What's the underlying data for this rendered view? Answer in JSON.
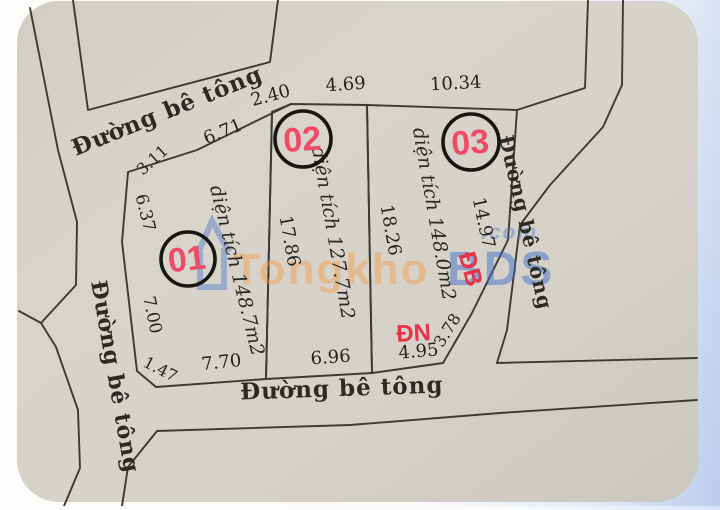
{
  "diagram": {
    "colors": {
      "paper": "#d6d2ca",
      "paper_edge": "#c8c4bb",
      "line": "#3c3a33",
      "text": "#25241e",
      "plot_number_red": "#ef4b66",
      "direction_red": "#e73349",
      "watermark_orange": "#f59a40",
      "watermark_blue": "#3e6dc9",
      "background_right": "#b9cceb"
    },
    "lines": [
      {
        "name": "top-parcel-boundary",
        "closed": false,
        "pts": [
          [
            73,
            0
          ],
          [
            88,
            110
          ],
          [
            270,
            62
          ],
          [
            278,
            0
          ]
        ]
      },
      {
        "name": "left-outer-boundary-upper",
        "closed": false,
        "pts": [
          [
            30,
            8
          ],
          [
            58,
            150
          ],
          [
            77,
            222
          ],
          [
            76,
            285
          ],
          [
            41,
            323
          ]
        ]
      },
      {
        "name": "left-boundary-fork",
        "closed": false,
        "pts": [
          [
            41,
            323
          ],
          [
            19,
            311
          ]
        ]
      },
      {
        "name": "left-outer-boundary-lower",
        "closed": false,
        "pts": [
          [
            41,
            323
          ],
          [
            56,
            347
          ],
          [
            78,
            410
          ],
          [
            80,
            468
          ],
          [
            64,
            506
          ]
        ]
      },
      {
        "name": "plot-01-boundary",
        "closed": true,
        "pts": [
          [
            291,
            104
          ],
          [
            197,
            150
          ],
          [
            128,
            172
          ],
          [
            122,
            242
          ],
          [
            137,
            371
          ],
          [
            156,
            387
          ],
          [
            266,
            379
          ],
          [
            272,
            112
          ]
        ]
      },
      {
        "name": "plot-02-boundary",
        "closed": true,
        "pts": [
          [
            272,
            112
          ],
          [
            291,
            104
          ],
          [
            367,
            105
          ],
          [
            372,
            373
          ],
          [
            266,
            379
          ]
        ]
      },
      {
        "name": "plot-03-boundary",
        "closed": true,
        "pts": [
          [
            367,
            105
          ],
          [
            517,
            110
          ],
          [
            508,
            240
          ],
          [
            472,
            313
          ],
          [
            443,
            363
          ],
          [
            372,
            373
          ]
        ]
      },
      {
        "name": "right-road-inner-boundary",
        "closed": false,
        "pts": [
          [
            588,
            0
          ],
          [
            585,
            88
          ],
          [
            517,
            110
          ]
        ]
      },
      {
        "name": "right-road-outer-boundary",
        "closed": false,
        "pts": [
          [
            623,
            0
          ],
          [
            622,
            85
          ],
          [
            603,
            127
          ],
          [
            550,
            185
          ],
          [
            520,
            225
          ],
          [
            507,
            330
          ],
          [
            497,
            363
          ]
        ]
      },
      {
        "name": "right-parcel-top-boundary",
        "closed": false,
        "pts": [
          [
            497,
            363
          ],
          [
            697,
            358
          ]
        ]
      },
      {
        "name": "bottom-parcel-boundary",
        "closed": false,
        "pts": [
          [
            157,
            431
          ],
          [
            350,
            425
          ],
          [
            500,
            413
          ],
          [
            697,
            400
          ]
        ]
      },
      {
        "name": "bottom-left-boundary",
        "closed": false,
        "pts": [
          [
            157,
            431
          ],
          [
            128,
            467
          ],
          [
            122,
            506
          ]
        ]
      }
    ],
    "road_labels": [
      {
        "name": "road-label-top",
        "text": "Đường bê tông",
        "x": 170,
        "y": 118,
        "rot": -22,
        "size": 23
      },
      {
        "name": "road-label-left",
        "text": "Đường bê tông",
        "x": 108,
        "y": 378,
        "rot": 80,
        "size": 22
      },
      {
        "name": "road-label-bottom",
        "text": "Đường bê tông",
        "x": 342,
        "y": 396,
        "rot": -2,
        "size": 23
      },
      {
        "name": "road-label-right",
        "text": "Đường bê tông",
        "x": 519,
        "y": 224,
        "rot": 77,
        "size": 20
      }
    ],
    "dimension_labels": [
      {
        "text": "2.40",
        "x": 272,
        "y": 101,
        "rot": -15,
        "size": 18
      },
      {
        "text": "4.69",
        "x": 346,
        "y": 90,
        "rot": -4,
        "size": 18
      },
      {
        "text": "10.34",
        "x": 456,
        "y": 89,
        "rot": -3,
        "size": 18
      },
      {
        "text": "6.71",
        "x": 225,
        "y": 137,
        "rot": -22,
        "size": 18
      },
      {
        "text": "3.11",
        "x": 156,
        "y": 164,
        "rot": -42,
        "size": 16
      },
      {
        "text": "6.37",
        "x": 140,
        "y": 214,
        "rot": 76,
        "size": 17
      },
      {
        "text": "7.00",
        "x": 147,
        "y": 316,
        "rot": 78,
        "size": 17
      },
      {
        "text": "1.47",
        "x": 158,
        "y": 374,
        "rot": 27,
        "size": 16
      },
      {
        "text": "7.70",
        "x": 222,
        "y": 368,
        "rot": -6,
        "size": 18
      },
      {
        "text": "6.96",
        "x": 331,
        "y": 363,
        "rot": -4,
        "size": 18
      },
      {
        "text": "4.95",
        "x": 419,
        "y": 357,
        "rot": -5,
        "size": 18
      },
      {
        "text": "3.78",
        "x": 452,
        "y": 333,
        "rot": -58,
        "size": 16
      },
      {
        "text": "17.86",
        "x": 284,
        "y": 242,
        "rot": 80,
        "size": 18
      },
      {
        "text": "18.26",
        "x": 385,
        "y": 231,
        "rot": 80,
        "size": 18
      },
      {
        "text": "14.97",
        "x": 478,
        "y": 224,
        "rot": 78,
        "size": 18
      }
    ],
    "area_labels": [
      {
        "name": "plot-01-area",
        "text": "diện tích 148.7m2",
        "x": 231,
        "y": 272,
        "rot": 76,
        "size": 19
      },
      {
        "name": "plot-02-area",
        "text": "diện tích 127.7m2",
        "x": 327,
        "y": 234,
        "rot": 80,
        "size": 19
      },
      {
        "name": "plot-03-area",
        "text": "diện tích 148.0m2",
        "x": 428,
        "y": 215,
        "rot": 80,
        "size": 19
      }
    ],
    "direction_labels": [
      {
        "name": "direction-label-db",
        "text": "ĐB",
        "x": 463,
        "y": 271,
        "rot": 75,
        "size": 24
      },
      {
        "name": "direction-label-dn",
        "text": "ĐN",
        "x": 414,
        "y": 341,
        "rot": -3,
        "size": 24
      }
    ],
    "plots": [
      {
        "number": "01",
        "cx": 188,
        "cy": 259,
        "r": 27,
        "num_rot": -6
      },
      {
        "number": "02",
        "cx": 303,
        "cy": 139,
        "r": 28,
        "num_rot": -4
      },
      {
        "number": "03",
        "cx": 471,
        "cy": 142,
        "r": 28,
        "num_rot": -4
      }
    ]
  },
  "watermark": {
    "texts": [
      {
        "name": "watermark-tongkho",
        "text": "Tongkho",
        "x": 233,
        "y": 284,
        "size": 44,
        "cls": "wm-orange"
      },
      {
        "name": "watermark-bds",
        "text": "BDS",
        "x": 447,
        "y": 285,
        "size": 48,
        "cls": "wm-blue"
      },
      {
        "name": "watermark-com",
        "text": ".com",
        "x": 481,
        "y": 239,
        "size": 21,
        "cls": "wm-com"
      }
    ]
  }
}
